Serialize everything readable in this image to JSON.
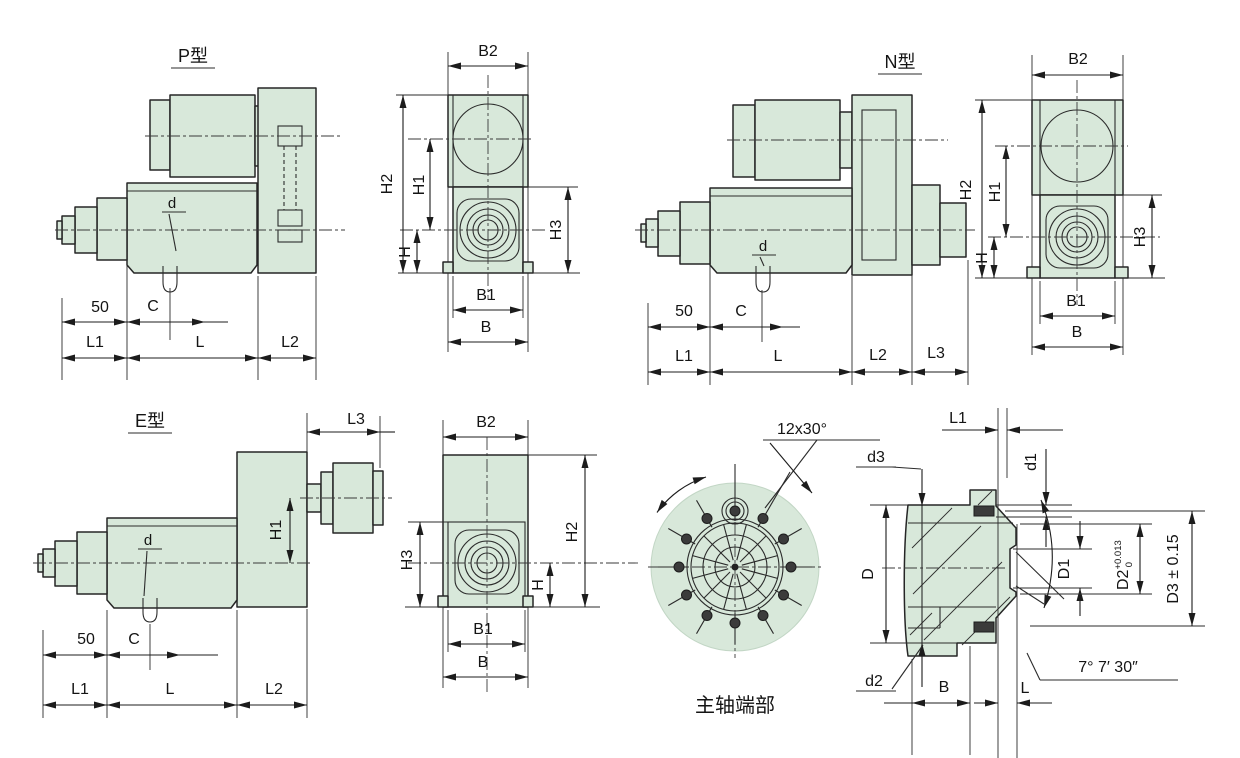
{
  "colors": {
    "part_fill": "#d8e8da",
    "line": "#262626",
    "background": "#ffffff"
  },
  "views": {
    "p_side": {
      "title": "P型",
      "dims": {
        "d": "d",
        "len50": "50",
        "c": "C",
        "l1": "L1",
        "l": "L",
        "l2": "L2"
      }
    },
    "p_front": {
      "dims": {
        "b2": "B2",
        "h2": "H2",
        "h1": "H1",
        "h": "H",
        "h3": "H3",
        "b1": "B1",
        "b": "B"
      }
    },
    "n_side": {
      "title": "N型",
      "dims": {
        "d": "d",
        "len50": "50",
        "c": "C",
        "l1": "L1",
        "l": "L",
        "l2": "L2",
        "l3": "L3"
      }
    },
    "n_front": {
      "dims": {
        "b2": "B2",
        "h2": "H2",
        "h1": "H1",
        "h": "H",
        "h3": "H3",
        "b1": "B1",
        "b": "B"
      }
    },
    "e_side": {
      "title": "E型",
      "dims": {
        "l3": "L3",
        "h1": "H1",
        "d": "d",
        "len50": "50",
        "c": "C",
        "l1": "L1",
        "l": "L",
        "l2": "L2"
      }
    },
    "e_front": {
      "dims": {
        "b2": "B2",
        "h3": "H3",
        "h2": "H2",
        "h": "H",
        "b1": "B1",
        "b": "B"
      }
    },
    "spindle_face": {
      "title": "主轴端部",
      "bolt_pattern": "12x30°"
    },
    "spindle_section": {
      "dims": {
        "l1": "L1",
        "d1": "d1",
        "d3": "d3",
        "D": "D",
        "D1": "D1",
        "D2": "D2",
        "D2_tol_upper": "+0.013",
        "D2_tol_lower": "0",
        "D3": "D3 ± 0.15",
        "d2": "d2",
        "b": "B",
        "l": "L",
        "taper_angle": "7° 7′ 30″"
      }
    }
  }
}
